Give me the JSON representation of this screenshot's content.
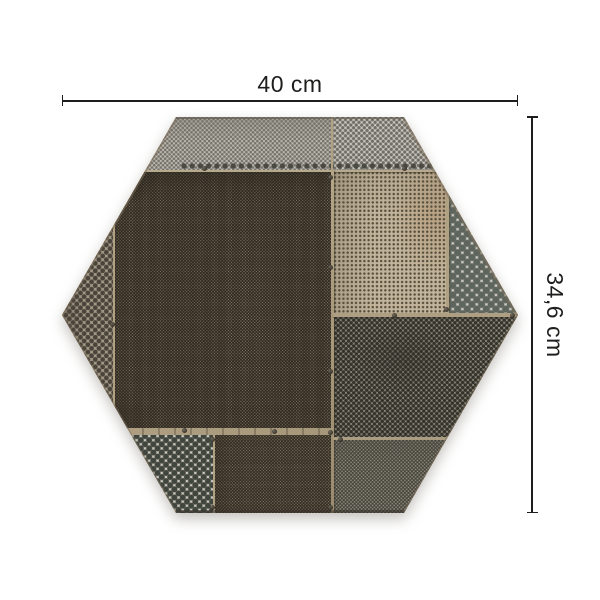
{
  "page": {
    "background": "#ffffff"
  },
  "product": {
    "name": "hexagonal-perforated-metal-tile",
    "description": "Hexagonal patchwork tile assembled from riveted perforated metal sheets",
    "shape": "regular hexagon, flat top and bottom, side vertices left and right",
    "panels": [
      "light-grey fine-perforated top band",
      "bronze fine-mesh central panel",
      "tan finely-perforated upper-right sheet",
      "light sheet with large dark dots at right vertex",
      "grey-green medium-perforated lower-right panel",
      "fine-perforated lower-right strip",
      "large-dot sheet at lower left",
      "bronze mesh bottom-center panel",
      "medium-hole strips along left slopes"
    ]
  },
  "dimensions": {
    "width_label": "40 cm",
    "height_label": "34,6 cm"
  },
  "colors": {
    "background": "#ffffff",
    "dimension_line": "#1e1e1c",
    "label_text": "#1e1e1c",
    "bronze_mesh": "#8b7a61",
    "light_grey_sheet": "#c6c2b9",
    "tan_sheet": "#c2b49b",
    "big_dot_sheet": "#d6d3ca",
    "dot_dark": "#40453e",
    "seam_tan": "#b0a183"
  }
}
